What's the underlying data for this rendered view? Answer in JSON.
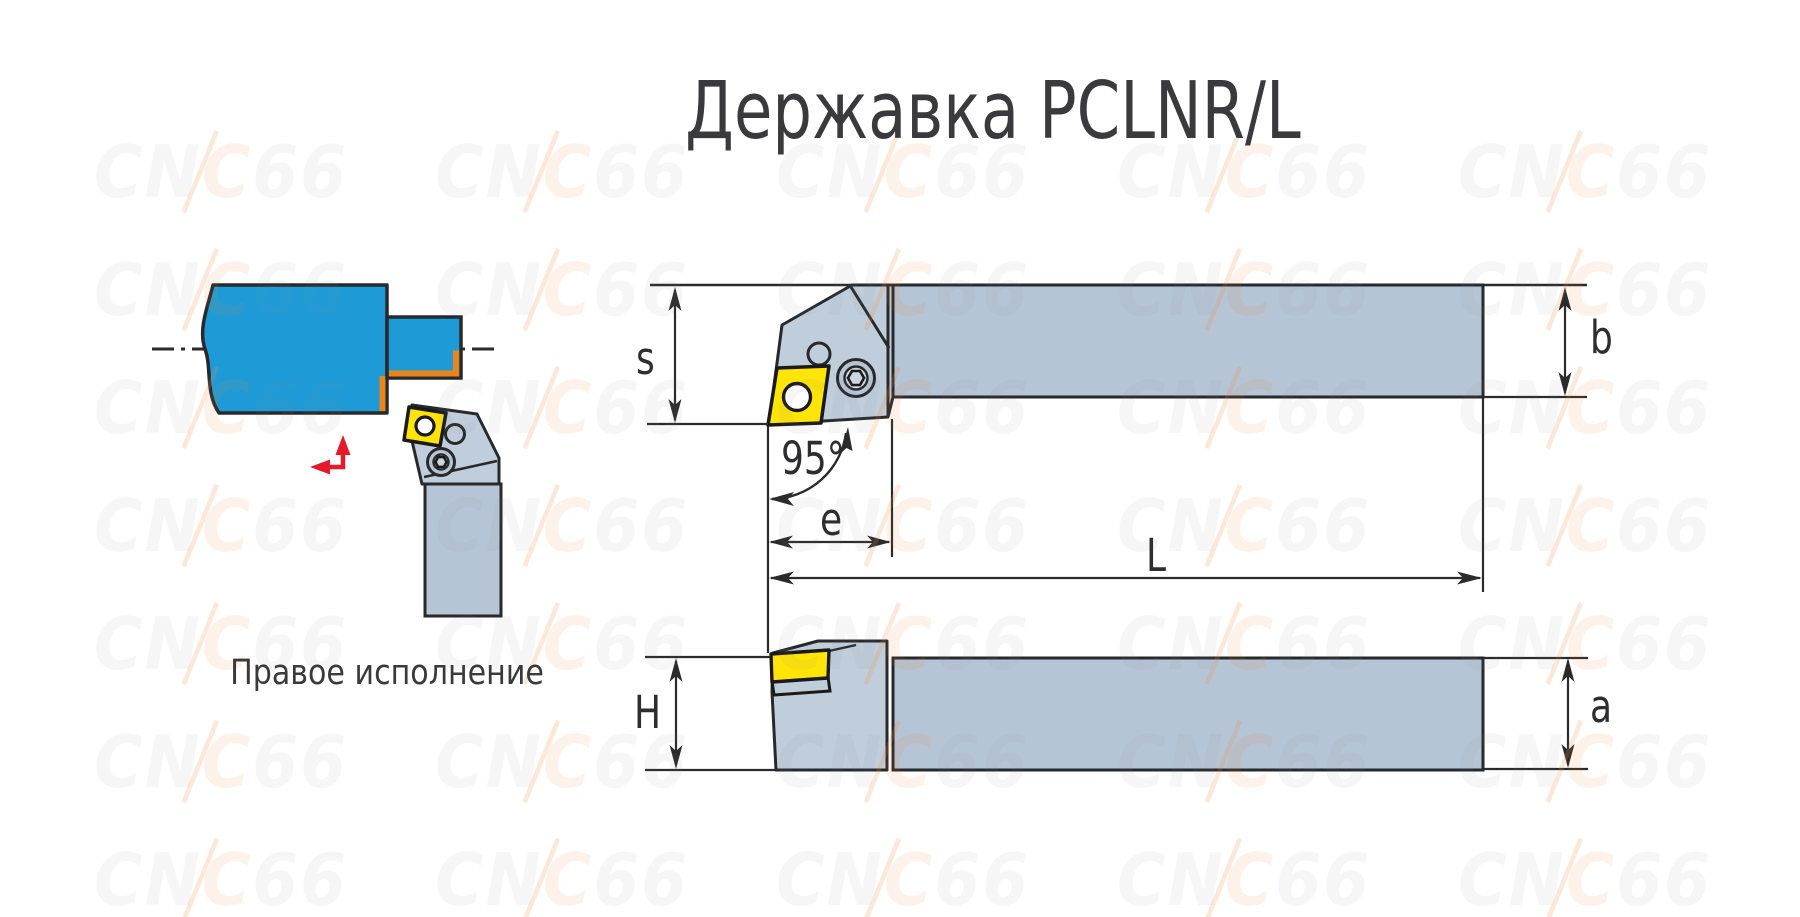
{
  "title": "Державка PCLNR/L",
  "caption": "Правое исполнение",
  "watermark": {
    "text": "CNC66"
  },
  "dimensions": {
    "s": "s",
    "b": "b",
    "angle": "95°",
    "e": "e",
    "L": "L",
    "H": "H",
    "a": "a"
  },
  "colors": {
    "workpiece_blue": "#1e9bd7",
    "machined_orange": "#e8851c",
    "insert_yellow": "#ffe408",
    "holder_gray": "#b6c5d5",
    "holder_gray_light": "#c0cedb",
    "outline_dark": "#27292b",
    "dimension_line": "#2b2b2b",
    "feed_arrow_red": "#e51a2b",
    "title_text": "#3a3a3c"
  }
}
